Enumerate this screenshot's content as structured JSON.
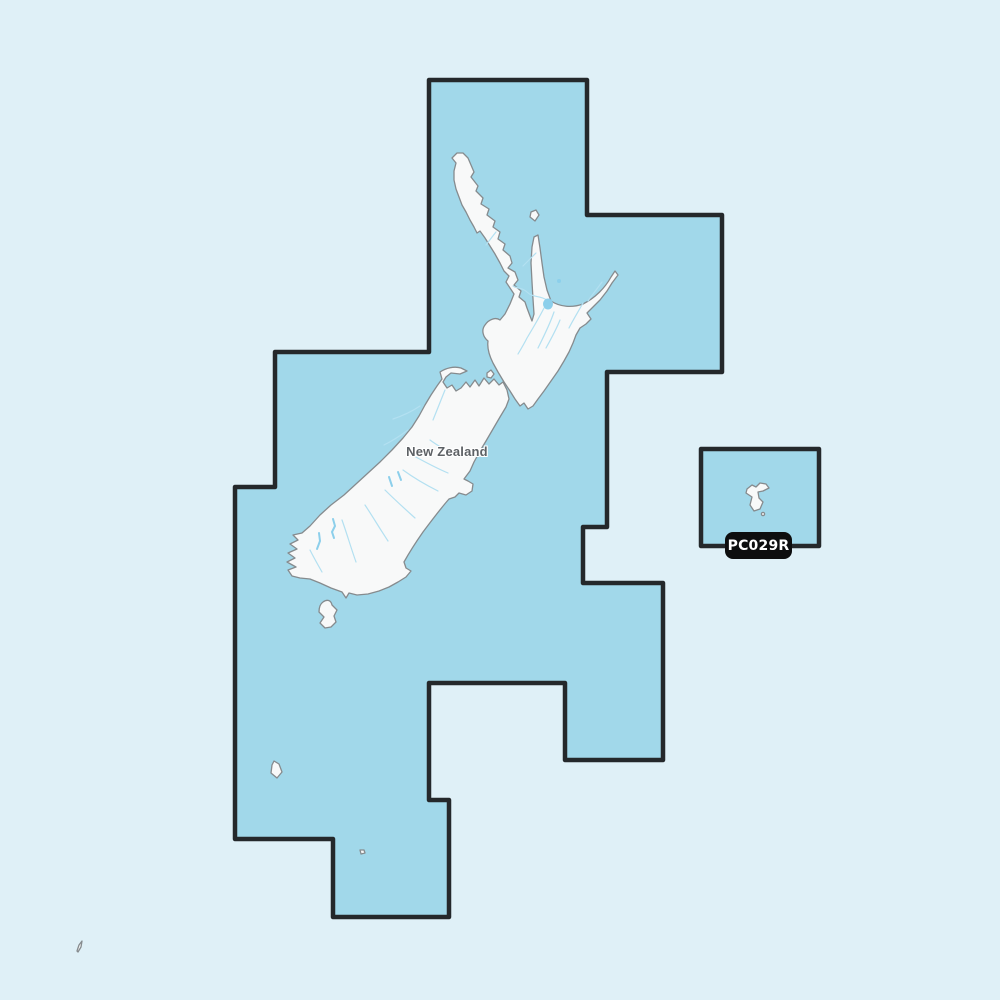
{
  "map": {
    "country_label": "New Zealand",
    "region_code": "PC029R"
  },
  "colors": {
    "page_bg": "#dff0f7",
    "region_fill": "#a1d8ea",
    "region_border": "#24282b",
    "land_fill": "#f8f9f9",
    "land_stroke": "#868b8e",
    "river": "#b3e0f1",
    "lake": "#8ccfeb",
    "badge_bg": "#0d0e0f",
    "badge_text": "#ffffff",
    "label_text": "#5d6165"
  }
}
